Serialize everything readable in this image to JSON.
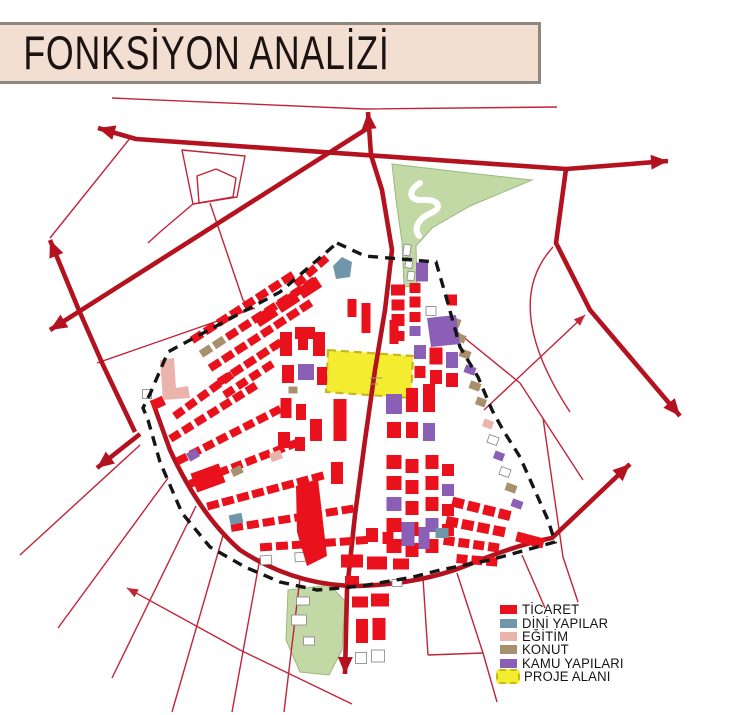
{
  "title": {
    "text": "FONKSİYON ANALİZİ"
  },
  "legend": {
    "items": [
      {
        "label": "TİCARET",
        "color_key": "red",
        "swatch": "solid"
      },
      {
        "label": "DİNİ YAPILAR",
        "color_key": "blue",
        "swatch": "solid"
      },
      {
        "label": "EĞİTİM",
        "color_key": "pink",
        "swatch": "solid"
      },
      {
        "label": "KONUT",
        "color_key": "tan",
        "swatch": "solid"
      },
      {
        "label": "KAMU YAPILARI",
        "color_key": "purple",
        "swatch": "solid"
      },
      {
        "label": "PROJE ALANI",
        "color_key": "yellow",
        "swatch": "dashed"
      }
    ]
  },
  "palette": {
    "road": "#b5121f",
    "thin": "#c22438",
    "red": "#e8111c",
    "blue": "#7195ab",
    "pink": "#eab4ac",
    "tan": "#a8906c",
    "purple": "#8a5fb5",
    "yellow": "#f4ec2f",
    "yellow_border": "#c9b520",
    "green": "#c2d8a5",
    "green_edge": "#9cb97e",
    "white": "#ffffff",
    "outline": "#8f8f8f",
    "boundary": "#161616",
    "banner_bg": "#f3ded2",
    "banner_border": "#8e8880"
  },
  "map": {
    "greens": [
      "M392,164 L460,172 L532,180 L470,206 L432,228 L416,246 L417,286 L404,287 L402,242 L396,200 Z",
      "M288,590 L330,585 L345,601 L342,650 L329,675 L300,672 L286,640 Z"
    ],
    "stream": "M420,183 C407,191 409,201 423,200 C439,199 443,208 431,213 C419,218 413,228 419,236",
    "project_area": "M328,350 L413,356 L411,398 L326,392 Z",
    "marks": [
      "M370,378 L382,378",
      "M370,384 L378,384"
    ],
    "boundary": "M337,243 L365,256 L436,262 L447,300 L460,347 L478,377 L492,410 L503,430 L520,457 L548,520 L555,542 L490,560 L440,570 L413,577 L362,586 L317,590 L280,582 L245,567 L210,547 L182,513 L160,462 L148,420 L143,408 L150,394 L168,352 L177,347 L280,292 Z",
    "roads_thick": [
      {
        "d": "M98,128 L136,139 L566,169",
        "arrows": [
          [
            98,
            128,
            196
          ]
        ]
      },
      {
        "d": "M566,169 L668,161",
        "arrows": [
          [
            668,
            161,
            -4
          ]
        ]
      },
      {
        "d": "M566,169 L556,243 L590,310 L680,416",
        "arrows": [
          [
            680,
            416,
            50
          ]
        ]
      },
      {
        "d": "M50,330 L368,128",
        "arrows": [
          [
            50,
            330,
            148
          ]
        ]
      },
      {
        "d": "M368,112 L371,155 L382,190 L392,250 L385,310 L375,370 L365,440 L355,515 L347,590 L345,674",
        "arrows": [
          [
            368,
            112,
            -94
          ],
          [
            345,
            674,
            91
          ]
        ]
      },
      {
        "d": "M50,240 L78,308 L103,365 L135,432",
        "arrows": [
          [
            50,
            240,
            -112
          ]
        ]
      },
      {
        "d": "M152,400 L170,450 Q200,515 240,550 Q295,586 358,586 Q425,584 475,562 Q520,544 552,538 L630,464",
        "arrows": [
          [
            630,
            464,
            -43
          ]
        ]
      },
      {
        "d": "M140,434 L97,468",
        "arrows": [
          [
            97,
            468,
            142
          ]
        ]
      }
    ],
    "roads_thin": [
      {
        "d": "M112,98 L365,109 L557,107"
      },
      {
        "d": "M131,137 L50,238"
      },
      {
        "d": "M182,150 L245,156 L237,197 L193,204 Z"
      },
      {
        "d": "M197,176 L216,169 L236,178 L233,197 L199,203 Z"
      },
      {
        "d": "M193,204 L160,232 L148,243"
      },
      {
        "d": "M210,203 L226,250 L243,300 L251,308"
      },
      {
        "d": "M97,363 L255,308"
      },
      {
        "d": "M553,247 Q500,305 570,412"
      },
      {
        "d": "M440,318 L520,383 L583,480"
      },
      {
        "d": "M484,410 L585,315",
        "arrows": [
          [
            585,
            315,
            -43
          ]
        ]
      },
      {
        "d": "M543,418 L563,557 L578,602"
      },
      {
        "d": "M522,555 L545,608"
      },
      {
        "d": "M423,578 L428,655"
      },
      {
        "d": "M457,573 L483,653 L497,702"
      },
      {
        "d": "M428,655 L483,653"
      },
      {
        "d": "M140,445 L20,555"
      },
      {
        "d": "M168,478 L58,628"
      },
      {
        "d": "M196,506 L112,678"
      },
      {
        "d": "M224,532 L172,712"
      },
      {
        "d": "M260,558 L232,712"
      },
      {
        "d": "M300,578 L284,712"
      },
      {
        "d": "M127,588 L240,650 L352,704",
        "arrows": [
          [
            127,
            588,
            -151
          ]
        ]
      }
    ],
    "strips": [
      {
        "s": [
          197,
          337
        ],
        "a": -33,
        "n": 8,
        "g": 15.5,
        "r": [
          12,
          8
        ],
        "c": "red"
      },
      {
        "s": [
          206,
          351
        ],
        "a": -33,
        "n": 9,
        "g": 15.5,
        "r": [
          12,
          8
        ],
        "c": "red",
        "alt": {
          "0": "tan",
          "1": "tan"
        }
      },
      {
        "s": [
          215,
          365
        ],
        "a": -33,
        "n": 8,
        "g": 15.5,
        "r": [
          12,
          8
        ],
        "c": "red"
      },
      {
        "s": [
          224,
          379
        ],
        "a": -33,
        "n": 5,
        "g": 15.5,
        "r": [
          12,
          8
        ],
        "c": "red"
      },
      {
        "s": [
          229,
          392
        ],
        "a": -33,
        "n": 4,
        "g": 15.5,
        "r": [
          11,
          8
        ],
        "c": "red"
      },
      {
        "s": [
          266,
          316
        ],
        "a": -33,
        "n": 3,
        "g": 26,
        "r": [
          22,
          12
        ],
        "c": "red"
      },
      {
        "s": [
          300,
          281
        ],
        "a": -41,
        "n": 3,
        "g": 15,
        "r": [
          11,
          8
        ],
        "c": "red"
      },
      {
        "s": [
          179,
          413
        ],
        "a": -36,
        "n": 5,
        "g": 15,
        "r": [
          11,
          8
        ],
        "c": "red"
      },
      {
        "s": [
          175,
          436
        ],
        "a": -32,
        "n": 7,
        "g": 15,
        "r": [
          11,
          8
        ],
        "c": "red"
      },
      {
        "s": [
          182,
          459
        ],
        "a": -27,
        "n": 8,
        "g": 15,
        "r": [
          11,
          8
        ],
        "c": "red"
      },
      {
        "s": [
          195,
          482
        ],
        "a": -21,
        "n": 8,
        "g": 15,
        "r": [
          11,
          8
        ],
        "c": "red"
      },
      {
        "s": [
          213,
          505
        ],
        "a": -15,
        "n": 8,
        "g": 15.5,
        "r": [
          12,
          8
        ],
        "c": "red"
      },
      {
        "s": [
          237,
          527
        ],
        "a": -9,
        "n": 8,
        "g": 16,
        "r": [
          12,
          8
        ],
        "c": "red"
      },
      {
        "s": [
          266,
          547
        ],
        "a": -4,
        "n": 7,
        "g": 16,
        "r": [
          12,
          8
        ],
        "c": "red"
      },
      {
        "s": [
          394,
          462
        ],
        "a": 90,
        "ra": 0,
        "n": 5,
        "g": 21,
        "r": [
          15,
          14
        ],
        "c": "red",
        "alt": {
          "2": "purple"
        }
      },
      {
        "s": [
          412,
          466
        ],
        "a": 90,
        "ra": 0,
        "n": 5,
        "g": 21,
        "r": [
          13,
          14
        ],
        "c": "red"
      },
      {
        "s": [
          432,
          462
        ],
        "a": 90,
        "ra": 0,
        "n": 5,
        "g": 21,
        "r": [
          13,
          14
        ],
        "c": "red",
        "alt": {
          "3": "purple"
        }
      },
      {
        "s": [
          448,
          470
        ],
        "a": 90,
        "ra": 0,
        "n": 4,
        "g": 20,
        "r": [
          12,
          12
        ],
        "c": "red",
        "alt": {
          "1": "purple"
        }
      },
      {
        "s": [
          458,
          503
        ],
        "a": 14,
        "n": 4,
        "g": 16,
        "r": [
          12,
          10
        ],
        "c": "red"
      },
      {
        "s": [
          452,
          522
        ],
        "a": 11,
        "n": 4,
        "g": 16,
        "r": [
          12,
          10
        ],
        "c": "red"
      },
      {
        "s": [
          449,
          541
        ],
        "a": 8,
        "n": 4,
        "g": 15,
        "r": [
          11,
          9
        ],
        "c": "red"
      },
      {
        "s": [
          462,
          559
        ],
        "a": 5,
        "n": 3,
        "g": 15,
        "r": [
          11,
          9
        ],
        "c": "red"
      }
    ],
    "rects": [
      [
        286,
        344,
        12,
        24,
        "red"
      ],
      [
        303,
        341,
        10,
        18,
        "red"
      ],
      [
        319,
        344,
        12,
        24,
        "red"
      ],
      [
        306,
        372,
        16,
        16,
        "purple"
      ],
      [
        288,
        374,
        12,
        18,
        "red"
      ],
      [
        322,
        376,
        10,
        18,
        "red"
      ],
      [
        293,
        390,
        9,
        7,
        "tan"
      ],
      [
        286,
        408,
        11,
        20,
        "red"
      ],
      [
        301,
        412,
        10,
        16,
        "red"
      ],
      [
        316,
        430,
        12,
        22,
        "red"
      ],
      [
        284,
        440,
        12,
        16,
        "red"
      ],
      [
        300,
        444,
        10,
        14,
        "red"
      ],
      [
        305,
        333,
        20,
        12,
        "red"
      ],
      [
        352,
        308,
        9,
        18,
        "red"
      ],
      [
        366,
        318,
        9,
        30,
        "red"
      ],
      [
        340,
        420,
        13,
        42,
        "red"
      ],
      [
        337,
        473,
        12,
        22,
        "red"
      ],
      [
        372,
        535,
        12,
        14,
        "red"
      ],
      [
        388,
        538,
        11,
        12,
        "red"
      ],
      [
        394,
        404,
        16,
        20,
        "purple"
      ],
      [
        394,
        430,
        14,
        16,
        "red"
      ],
      [
        412,
        400,
        12,
        24,
        "red"
      ],
      [
        412,
        430,
        12,
        16,
        "red"
      ],
      [
        429,
        398,
        12,
        28,
        "red"
      ],
      [
        429,
        432,
        12,
        18,
        "purple"
      ],
      [
        394,
        332,
        9,
        24,
        "red"
      ],
      [
        422,
        272,
        12,
        19,
        "purple"
      ],
      [
        398,
        290,
        14,
        11,
        "red"
      ],
      [
        398,
        305,
        13,
        11,
        "red"
      ],
      [
        398,
        320,
        13,
        12,
        "red"
      ],
      [
        398,
        336,
        13,
        10,
        "red"
      ],
      [
        415,
        288,
        11,
        10,
        "red"
      ],
      [
        415,
        302,
        11,
        11,
        "red"
      ],
      [
        415,
        317,
        11,
        10,
        "red"
      ],
      [
        415,
        331,
        11,
        10,
        "purple"
      ],
      [
        431,
        311,
        10,
        9,
        "white"
      ],
      [
        452,
        300,
        10,
        11,
        "red"
      ],
      [
        420,
        352,
        12,
        14,
        "purple"
      ],
      [
        436,
        356,
        13,
        17,
        "red"
      ],
      [
        452,
        360,
        12,
        16,
        "purple"
      ],
      [
        452,
        380,
        12,
        14,
        "red"
      ],
      [
        436,
        377,
        12,
        14,
        "red"
      ],
      [
        420,
        372,
        11,
        12,
        "red"
      ],
      [
        455,
        322,
        11,
        8,
        "tan",
        20
      ],
      [
        460,
        338,
        11,
        8,
        "tan",
        20
      ],
      [
        465,
        354,
        11,
        8,
        "tan",
        20
      ],
      [
        470,
        370,
        11,
        8,
        "purple",
        20
      ],
      [
        475,
        386,
        11,
        8,
        "tan",
        20
      ],
      [
        481,
        402,
        10,
        8,
        "tan",
        20
      ],
      [
        488,
        424,
        10,
        8,
        "pink",
        20
      ],
      [
        493,
        440,
        10,
        8,
        "white",
        20
      ],
      [
        499,
        456,
        10,
        8,
        "purple",
        20
      ],
      [
        505,
        472,
        10,
        8,
        "white",
        20
      ],
      [
        511,
        488,
        11,
        8,
        "tan",
        20
      ],
      [
        517,
        504,
        11,
        8,
        "purple",
        20
      ],
      [
        530,
        540,
        28,
        10,
        "red",
        15
      ],
      [
        352,
        561,
        22,
        13,
        "red"
      ],
      [
        377,
        563,
        20,
        13,
        "red"
      ],
      [
        401,
        564,
        16,
        11,
        "red"
      ],
      [
        352,
        580,
        14,
        8,
        "red"
      ],
      [
        397,
        583,
        10,
        7,
        "white"
      ],
      [
        408,
        534,
        13,
        24,
        "purple"
      ],
      [
        424,
        538,
        11,
        22,
        "purple"
      ],
      [
        442,
        533,
        13,
        10,
        "blue"
      ],
      [
        360,
        602,
        16,
        11,
        "red"
      ],
      [
        380,
        600,
        18,
        13,
        "red"
      ],
      [
        362,
        631,
        12,
        24,
        "red"
      ],
      [
        379,
        629,
        13,
        22,
        "red"
      ],
      [
        361,
        658,
        11,
        11,
        "white"
      ],
      [
        378,
        656,
        13,
        12,
        "white"
      ],
      [
        147,
        394,
        9,
        9,
        "white"
      ],
      [
        158,
        403,
        13,
        10,
        "red",
        -25
      ],
      [
        236,
        519,
        13,
        10,
        "blue",
        -12
      ],
      [
        276,
        456,
        12,
        9,
        "pink",
        -20
      ],
      [
        237,
        471,
        11,
        8,
        "tan",
        -25
      ],
      [
        193,
        455,
        11,
        9,
        "purple",
        -30
      ],
      [
        266,
        560,
        11,
        9,
        "white",
        -4
      ],
      [
        301,
        557,
        12,
        9,
        "white",
        -4
      ],
      [
        208,
        478,
        30,
        20,
        "red",
        -20
      ],
      [
        303,
        601,
        13,
        8,
        "white"
      ],
      [
        299,
        620,
        15,
        10,
        "white"
      ],
      [
        309,
        641,
        11,
        8,
        "white"
      ],
      [
        407,
        250,
        7,
        11,
        "white",
        8
      ],
      [
        409,
        263,
        7,
        10,
        "white",
        8
      ],
      [
        411,
        276,
        7,
        9,
        "white",
        8
      ]
    ],
    "polys": [
      {
        "d": "M333,266 L342,257 L352,262 L350,277 L336,279 Z",
        "c": "blue"
      },
      {
        "d": "M160,360 L174,358 L176,388 L188,386 L190,398 L163,400 Z",
        "c": "pink"
      },
      {
        "d": "M296,486 L318,479 L327,556 L307,566 L297,532 Z",
        "c": "red"
      },
      {
        "d": "M427,318 L456,315 L460,344 L431,347 Z",
        "c": "purple"
      }
    ]
  }
}
